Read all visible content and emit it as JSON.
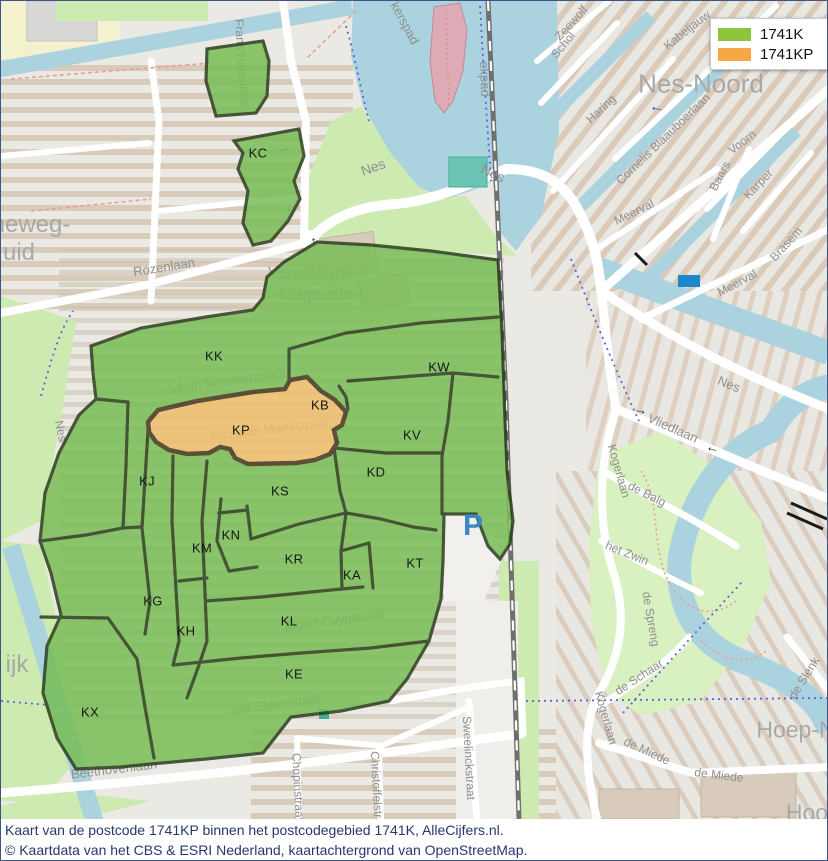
{
  "legend": {
    "items": [
      {
        "label": "1741K",
        "color": "#8CC63E"
      },
      {
        "label": "1741KP",
        "color": "#F6A846"
      }
    ]
  },
  "caption": {
    "line1": "Kaart van de postcode 1741KP binnen het postcodegebied 1741K, AlleCijfers.nl.",
    "line2": "© Kaartdata van het CBS & ESRI Nederland, kaartachtergrond van OpenStreetMap."
  },
  "map": {
    "colors": {
      "region_fill": "#79BE58",
      "region_stroke": "#2C3E1C",
      "highlight_fill": "#EFBE6C",
      "highlight_stroke": "#46391E",
      "water": "#AAD3DF",
      "park": "#CDEBB0",
      "road": "#FFFFFF",
      "rail": "#707070",
      "background": "#EBE9E4",
      "caption_text": "#28386E",
      "parking_blue": "#3B87C8"
    },
    "poi": {
      "parking_letter": "P"
    },
    "region_labels": [
      {
        "text": "KC",
        "x": 257,
        "y": 152
      },
      {
        "text": "KK",
        "x": 213,
        "y": 355
      },
      {
        "text": "KW",
        "x": 438,
        "y": 366
      },
      {
        "text": "KB",
        "x": 319,
        "y": 404
      },
      {
        "text": "KP",
        "x": 240,
        "y": 429
      },
      {
        "text": "KV",
        "x": 411,
        "y": 434
      },
      {
        "text": "KJ",
        "x": 146,
        "y": 480
      },
      {
        "text": "KD",
        "x": 375,
        "y": 471
      },
      {
        "text": "KS",
        "x": 279,
        "y": 490
      },
      {
        "text": "KN",
        "x": 230,
        "y": 534
      },
      {
        "text": "KM",
        "x": 201,
        "y": 547
      },
      {
        "text": "KR",
        "x": 293,
        "y": 558
      },
      {
        "text": "KA",
        "x": 351,
        "y": 574
      },
      {
        "text": "KT",
        "x": 414,
        "y": 562
      },
      {
        "text": "KG",
        "x": 152,
        "y": 600
      },
      {
        "text": "KH",
        "x": 185,
        "y": 630
      },
      {
        "text": "KL",
        "x": 288,
        "y": 620
      },
      {
        "text": "KE",
        "x": 293,
        "y": 673
      },
      {
        "text": "KX",
        "x": 89,
        "y": 711
      }
    ],
    "street_labels": [
      {
        "text": "Frans Halsstraat",
        "x": 241,
        "y": 62,
        "rot": 86,
        "size": 12
      },
      {
        "text": "kerspad",
        "x": 404,
        "y": 22,
        "rot": 62,
        "size": 13
      },
      {
        "text": "ekpad",
        "x": 484,
        "y": 78,
        "rot": 88,
        "size": 13
      },
      {
        "text": "Nes",
        "x": 372,
        "y": 166,
        "rot": -20,
        "size": 14
      },
      {
        "text": "Nes",
        "x": 492,
        "y": 172,
        "rot": 25,
        "size": 14
      },
      {
        "text": "Rozenlaan",
        "x": 163,
        "y": 266,
        "rot": -9,
        "size": 13
      },
      {
        "text": "Johan Vermeerstraat",
        "x": 225,
        "y": 380,
        "rot": -8,
        "size": 13
      },
      {
        "text": "Nicolaas Maesstraat",
        "x": 268,
        "y": 428,
        "rot": -7,
        "size": 13
      },
      {
        "text": "Albert Cuypstraat",
        "x": 333,
        "y": 619,
        "rot": -8,
        "size": 13
      },
      {
        "text": "Jan Steenstraat",
        "x": 274,
        "y": 703,
        "rot": -8,
        "size": 13
      },
      {
        "text": "Beethovenlaan",
        "x": 113,
        "y": 768,
        "rot": -7,
        "size": 13
      },
      {
        "text": "Chopinstraat",
        "x": 297,
        "y": 786,
        "rot": 87,
        "size": 12
      },
      {
        "text": "Christoffelstraat",
        "x": 376,
        "y": 792,
        "rot": 87,
        "size": 12
      },
      {
        "text": "Sweelinckstraat",
        "x": 468,
        "y": 757,
        "rot": 87,
        "size": 12
      },
      {
        "text": "Zeewolf",
        "x": 570,
        "y": 22,
        "rot": -48,
        "size": 12
      },
      {
        "text": "Schol",
        "x": 562,
        "y": 44,
        "rot": -50,
        "size": 12
      },
      {
        "text": "Kabeljauw",
        "x": 686,
        "y": 29,
        "rot": -38,
        "size": 12
      },
      {
        "text": "Haring",
        "x": 600,
        "y": 108,
        "rot": -43,
        "size": 12
      },
      {
        "text": "Cornelis Blaauboerlaan",
        "x": 662,
        "y": 138,
        "rot": -44,
        "size": 12
      },
      {
        "text": "Voorn",
        "x": 741,
        "y": 141,
        "rot": -38,
        "size": 12
      },
      {
        "text": "Baars",
        "x": 719,
        "y": 175,
        "rot": -62,
        "size": 12
      },
      {
        "text": "Karper",
        "x": 757,
        "y": 183,
        "rot": -46,
        "size": 12
      },
      {
        "text": "Brasem",
        "x": 785,
        "y": 243,
        "rot": -48,
        "size": 12
      },
      {
        "text": "Meerval",
        "x": 633,
        "y": 211,
        "rot": -26,
        "size": 12
      },
      {
        "text": "Meerval",
        "x": 736,
        "y": 282,
        "rot": -28,
        "size": 12
      },
      {
        "text": "Nes",
        "x": 728,
        "y": 383,
        "rot": 22,
        "size": 13
      },
      {
        "text": "Vliedlaan",
        "x": 672,
        "y": 427,
        "rot": 24,
        "size": 13
      },
      {
        "text": "Kogerlaan",
        "x": 618,
        "y": 470,
        "rot": 74,
        "size": 12
      },
      {
        "text": "de Balg",
        "x": 646,
        "y": 493,
        "rot": 27,
        "size": 12
      },
      {
        "text": "het Zwin",
        "x": 626,
        "y": 552,
        "rot": 22,
        "size": 12
      },
      {
        "text": "de Spreng",
        "x": 650,
        "y": 618,
        "rot": 80,
        "size": 12
      },
      {
        "text": "de Schaar",
        "x": 638,
        "y": 676,
        "rot": -33,
        "size": 12
      },
      {
        "text": "Kogerlaan",
        "x": 605,
        "y": 717,
        "rot": 74,
        "size": 12
      },
      {
        "text": "de Miede",
        "x": 646,
        "y": 750,
        "rot": 25,
        "size": 12
      },
      {
        "text": "de Miede",
        "x": 718,
        "y": 774,
        "rot": 7,
        "size": 12
      },
      {
        "text": "de Slenk",
        "x": 803,
        "y": 677,
        "rot": -58,
        "size": 12
      },
      {
        "text": "Nes",
        "x": 60,
        "y": 430,
        "rot": 78,
        "size": 12
      }
    ],
    "district_labels": [
      {
        "text": "Nes-Noord",
        "x": 700,
        "y": 83,
        "size": 26
      },
      {
        "text": "Verpleeghuis",
        "x": 316,
        "y": 272,
        "size": 17
      },
      {
        "text": "Magnushof",
        "x": 320,
        "y": 294,
        "size": 17
      },
      {
        "text": "heweg-",
        "x": 30,
        "y": 224,
        "size": 24
      },
      {
        "text": "uid",
        "x": 18,
        "y": 252,
        "size": 24
      },
      {
        "text": "ijk",
        "x": 16,
        "y": 664,
        "size": 24
      },
      {
        "text": "Hoep-N",
        "x": 795,
        "y": 729,
        "size": 23
      },
      {
        "text": "Hoo",
        "x": 806,
        "y": 812,
        "size": 23
      }
    ],
    "arrows": [
      {
        "glyph": "←",
        "x": 283,
        "y": 147,
        "rot": -18,
        "color": "#2D3E9E",
        "size": 15
      },
      {
        "glyph": "↑",
        "x": 313,
        "y": 241,
        "rot": -12,
        "color": "#2D3E9E",
        "size": 15
      },
      {
        "glyph": "↓",
        "x": 288,
        "y": 206,
        "rot": 8,
        "color": "#2D3E9E",
        "size": 13
      },
      {
        "glyph": "←",
        "x": 656,
        "y": 106,
        "rot": 8,
        "color": "#2D3E9E",
        "size": 15
      },
      {
        "glyph": "→",
        "x": 640,
        "y": 408,
        "rot": 14,
        "color": "#3A3A3A",
        "size": 14
      },
      {
        "glyph": "←",
        "x": 712,
        "y": 446,
        "rot": 14,
        "color": "#3A3A3A",
        "size": 14
      }
    ]
  }
}
